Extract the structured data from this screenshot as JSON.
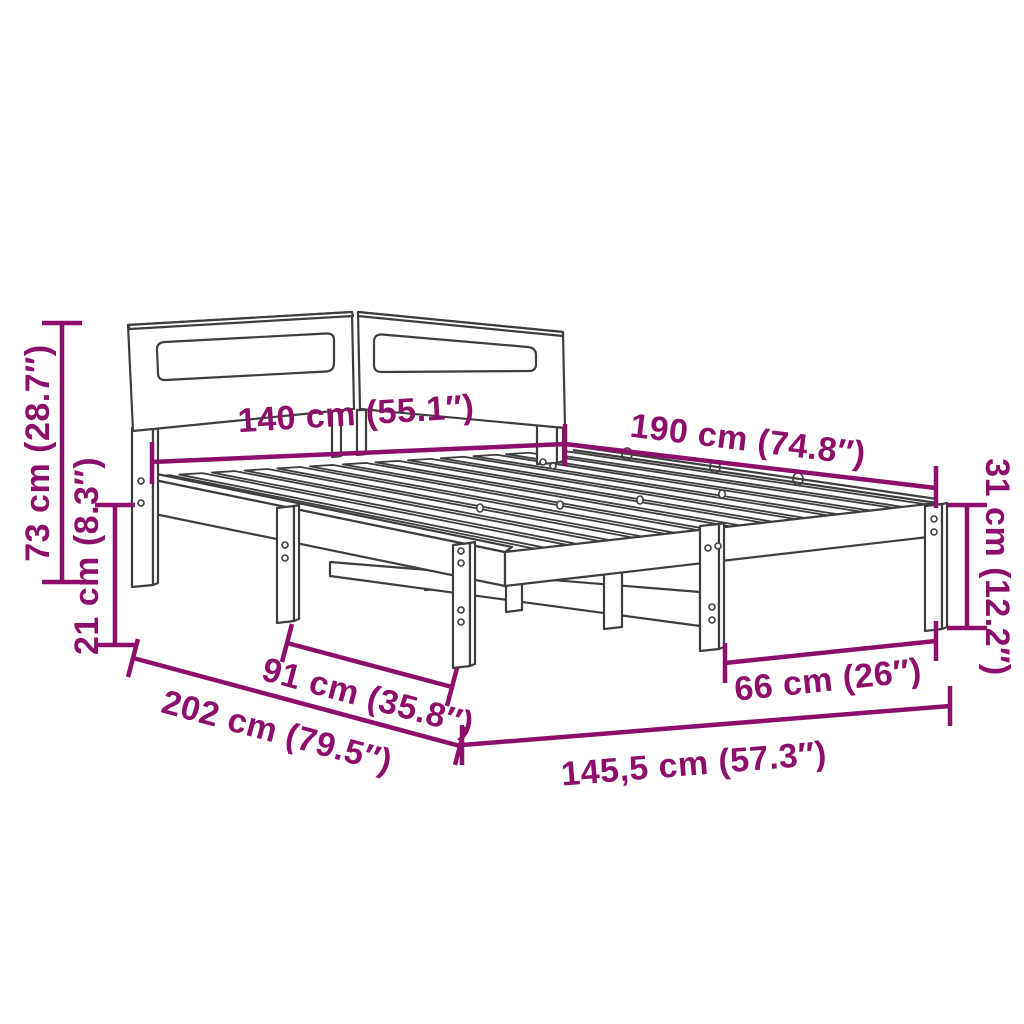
{
  "diagram": {
    "kind": "product-dimension-diagram",
    "subject": "bed-frame-with-slatted-base-and-headboard",
    "background_color": "#ffffff",
    "drawing_line_color": "#3e3e3e",
    "accent_color": "#8E0F6B",
    "dimensions": {
      "headboard_width": {
        "label": "140 cm (55.1″)",
        "value_cm": 140,
        "value_in": 55.1
      },
      "frame_length": {
        "label": "190 cm (74.8″)",
        "value_cm": 190,
        "value_in": 74.8
      },
      "headboard_height": {
        "label": "73 cm (28.7″)",
        "value_cm": 73,
        "value_in": 28.7
      },
      "clearance_height": {
        "label": "21 cm (8.3″)",
        "value_cm": 21,
        "value_in": 8.3
      },
      "frame_height": {
        "label": "31 cm (12.2″)",
        "value_cm": 31,
        "value_in": 12.2
      },
      "side_leg_spacing": {
        "label": "91 cm (35.8″)",
        "value_cm": 91,
        "value_in": 35.8
      },
      "total_length": {
        "label": "202 cm (79.5″)",
        "value_cm": 202,
        "value_in": 79.5
      },
      "foot_leg_spacing": {
        "label": "66 cm (26″)",
        "value_cm": 66,
        "value_in": 26
      },
      "total_width": {
        "label": "145,5 cm (57.3″)",
        "value_cm": 145.5,
        "value_in": 57.3
      }
    }
  }
}
